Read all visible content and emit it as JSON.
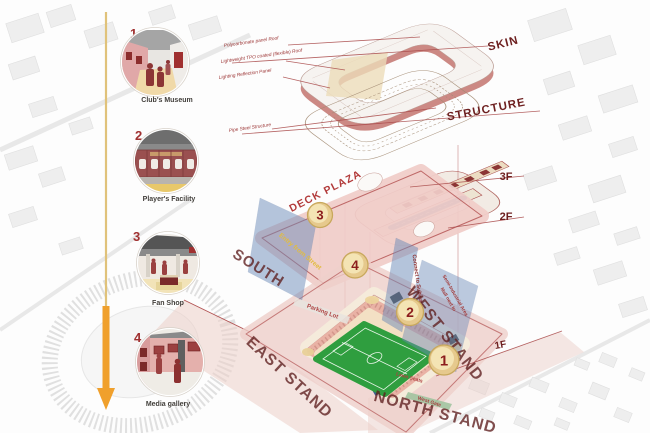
{
  "legend": {
    "items": [
      {
        "num": "1",
        "label": "Club's Museum"
      },
      {
        "num": "2",
        "label": "Player's Facility"
      },
      {
        "num": "3",
        "label": "Fan Shop"
      },
      {
        "num": "4",
        "label": "Media gallery"
      }
    ]
  },
  "layers": {
    "skin": "SKIN",
    "structure": "STRUCTURE",
    "f3": "3F",
    "f2": "2F",
    "f1": "1F",
    "deck": "DECK PLAZA"
  },
  "stands": {
    "south": "SOUTH",
    "east": "EAST STAND",
    "west": "WEST STAND",
    "north": "NORTH STAND"
  },
  "annotations": {
    "roof_note_1": "Polycarbonate panel Roof",
    "roof_note_2": "Lightweight TPO coated (flexible) Roof",
    "roof_note_3": "Lighting Reflection Panel",
    "structure_note": "Pipe Steel Structure",
    "entry_note": "Entry from Street",
    "connect_note": "Connect to Subway",
    "mall_note_1": "Mall next to",
    "mall_note_2": "Semi-Industrial Area",
    "parking_note": "Parking Lot",
    "lawn_note": "Lawn Seats",
    "gate_note": "West Gate"
  },
  "markers": {
    "m1": "1",
    "m2": "2",
    "m3": "3",
    "m4": "4"
  },
  "colors": {
    "accent_red": "#a84848",
    "label_maroon": "#5e1e1e",
    "deck_pink": "#f1cdc9",
    "plane_blue": "#6d8cba",
    "pitch_green": "#2f9e3f",
    "arrow_orange": "#f0a02c",
    "marker_yellow": "#f1dca6"
  }
}
